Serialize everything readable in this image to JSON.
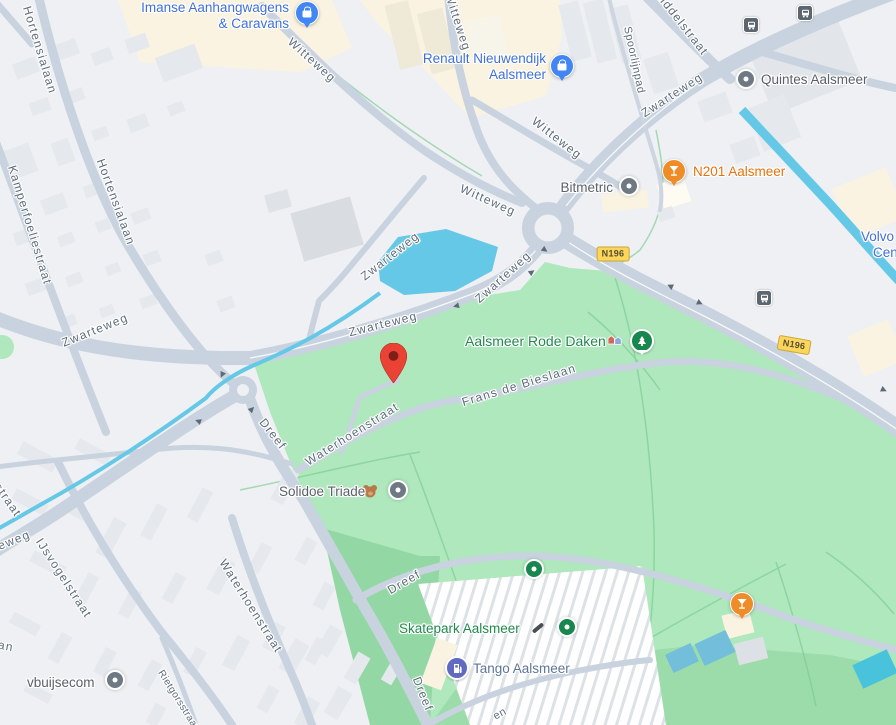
{
  "map": {
    "streets": [
      "Hortensialaan",
      "Hortensialaan",
      "Kamperfoeliestraat",
      "Witteweg",
      "Witteweg",
      "Witteweg",
      "Witteweg",
      "Spoorlijnpad",
      "Middelstraat",
      "Zwarteweg",
      "Zwarteweg",
      "Zwarteweg",
      "Zwarteweg",
      "Zwarteweg",
      "Dreef",
      "Dreef",
      "Dreef",
      "Frans de Bieslaan",
      "Waterhoenstraat",
      "Waterhoenstraat",
      "IJsvogelstraat",
      "Rietgorsstraat",
      "straat",
      "eweg",
      "an",
      "en"
    ],
    "shields": {
      "n196": "N196"
    },
    "pois": {
      "imanse": {
        "line1": "Imanse Aanhangwagens",
        "line2": "& Caravans"
      },
      "renault": {
        "line1": "Renault Nieuwendijk",
        "line2": "Aalsmeer"
      },
      "quintes": {
        "name": "Quintes Aalsmeer"
      },
      "n201": {
        "name": "N201 Aalsmeer"
      },
      "bitmetric": {
        "name": "Bitmetric"
      },
      "rode_daken": {
        "name": "Aalsmeer Rode Daken"
      },
      "solidoe": {
        "name": "Solidoe Triade"
      },
      "skatepark": {
        "name": "Skatepark Aalsmeer"
      },
      "tango": {
        "name": "Tango Aalsmeer"
      },
      "vbuijsecom": {
        "name": "vbuijsecom"
      },
      "volvo": {
        "line1": "Volvo",
        "line2": "Center"
      }
    },
    "colors": {
      "park_green": "#aee8bc",
      "park_green_dark": "#93d8a4",
      "water": "#66c8e7",
      "road": "#c9d3df",
      "background": "#eef0f3",
      "commercial_area": "#faf3e1",
      "pin_red": "#ea4335",
      "poi_orange": "#f08c28",
      "poi_green": "#17864f",
      "poi_blue": "#4285f4",
      "poi_gray": "#6e7983",
      "tango_indigo": "#5f6ac0",
      "shield_yellow": "#fbd65b",
      "label_blue": "#4070d6",
      "label_green": "#1f8a4c",
      "label_orange": "#e8710a",
      "label_gray": "#5b6068",
      "street_label": "#5e6c7b"
    }
  }
}
